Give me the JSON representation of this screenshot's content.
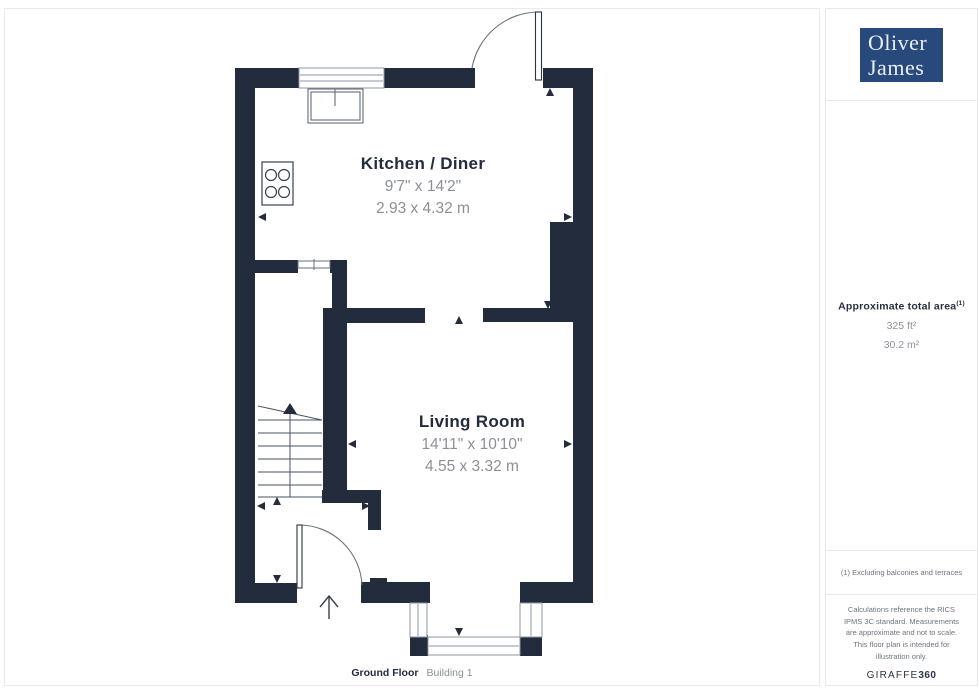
{
  "colors": {
    "wall": "#232C3D",
    "logo_blue": "#27497B",
    "text_dark": "#232C3D",
    "text_gray": "#8A909B",
    "frame_gray": "#8E95A3"
  },
  "plan": {
    "rooms": [
      {
        "name": "Kitchen / Diner",
        "imperial": "9'7\" x 14'2\"",
        "metric": "2.93 x 4.32 m"
      },
      {
        "name": "Living Room",
        "imperial": "14'11\" x 10'10\"",
        "metric": "4.55 x 3.32 m"
      }
    ],
    "caption": {
      "floor": "Ground Floor",
      "building": "Building 1"
    }
  },
  "sidebar": {
    "logo": {
      "line1": "Oliver",
      "line2": "James"
    },
    "area": {
      "title": "Approximate total area",
      "marker": "(1)",
      "imperial": "325 ft²",
      "metric": "30.2 m²"
    },
    "footnote": "(1) Excluding balconies and terraces",
    "disclaimer": "Calculations reference the RICS IPMS 3C standard. Measurements are approximate and not to scale. This floor plan is intended for illustration only.",
    "brand": {
      "name": "GIRAFFE",
      "suffix": "360"
    }
  }
}
